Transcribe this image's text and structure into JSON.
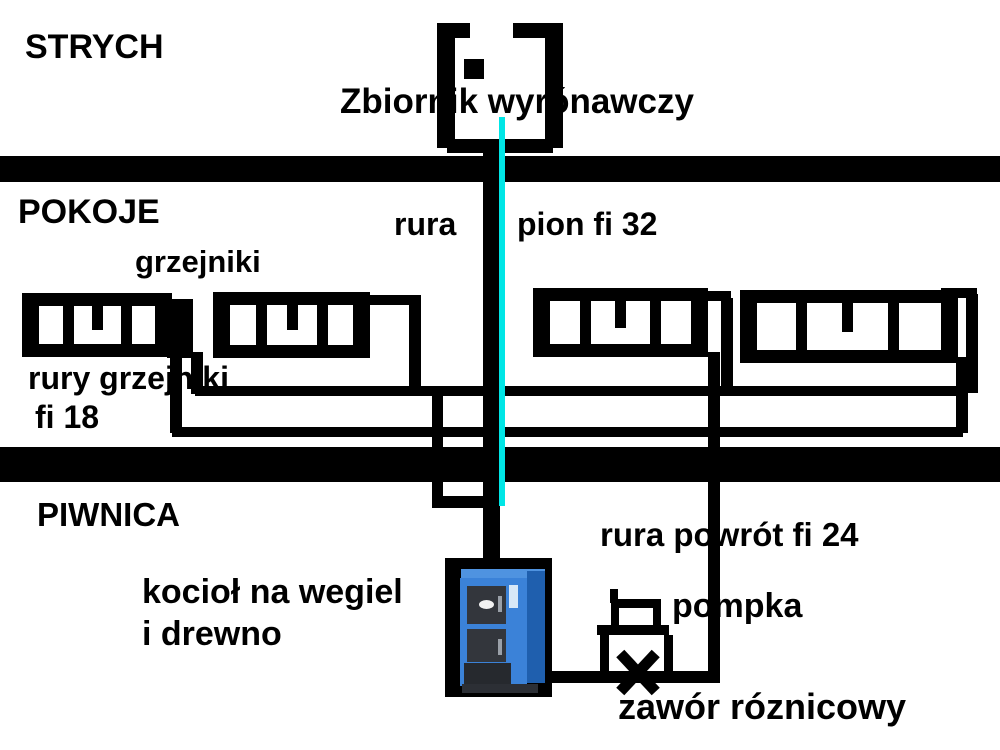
{
  "diagram": {
    "title_context": "heating-system-schematic",
    "floors": {
      "attic_label": "STRYCH",
      "rooms_label": "POKOJE",
      "basement_label": "PIWNICA"
    },
    "labels": {
      "tank": "Zbiornik wyrónawczy",
      "radiators": "grzejniki",
      "riser_word_left": "rura",
      "riser_word_right": "pion fi 32",
      "radiator_pipes_line1": "rury grzejniki",
      "radiator_pipes_line2": "fi 18",
      "boiler_line1": "kocioł na wegiel",
      "boiler_line2": "i drewno",
      "return_pipe": "rura powrót fi 24",
      "pump": "pompka",
      "valve": "zawór róznicowy"
    },
    "symbols": {
      "expansion_tank": "open-top tank, thick black outline",
      "radiator_count": 4,
      "pump_icon": "small box on base in bypass loop",
      "valve_icon": "X cross on return pipe",
      "boiler_photo": "blue solid-fuel boiler on black background"
    },
    "colors": {
      "line": "#000000",
      "background": "#ffffff",
      "riser_highlight": "#00e6e6",
      "boiler_blue": "#3b82d8",
      "boiler_door": "#33363c"
    }
  }
}
